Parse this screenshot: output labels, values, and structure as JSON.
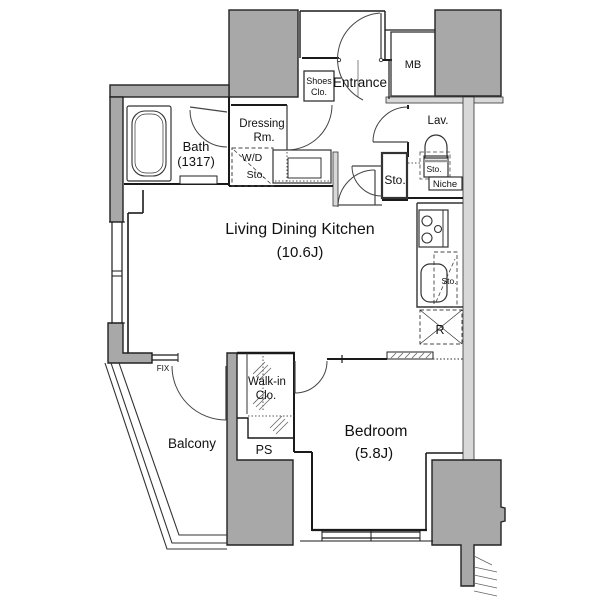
{
  "plan": {
    "type": "apartment-floorplan",
    "labels": {
      "entrance": "Entrance",
      "shoes_closet_1": "Shoes",
      "shoes_closet_2": "Clo.",
      "meter_box": "MB",
      "lavatory": "Lav.",
      "lav_storage": "Sto.",
      "niche": "Niche",
      "hall_storage": "Sto.",
      "dressing_1": "Dressing",
      "dressing_2": "Rm.",
      "wd_1": "W/D",
      "wd_2": "Sto.",
      "bath_1": "Bath",
      "bath_2": "(1317)",
      "ldk_1": "Living Dining Kitchen",
      "ldk_2": "(10.6J)",
      "kitchen_storage": "Sto.",
      "refrigerator": "R",
      "fix_window": "FIX",
      "balcony": "Balcony",
      "pipe_space": "PS",
      "walkin_1": "Walk-in",
      "walkin_2": "Clo.",
      "bedroom_1": "Bedroom",
      "bedroom_2": "(5.8J)"
    },
    "colors": {
      "pillar": "#a8a8a8",
      "light_wall": "#d8d8d8",
      "line": "#1a1a1a",
      "background": "#ffffff"
    }
  }
}
